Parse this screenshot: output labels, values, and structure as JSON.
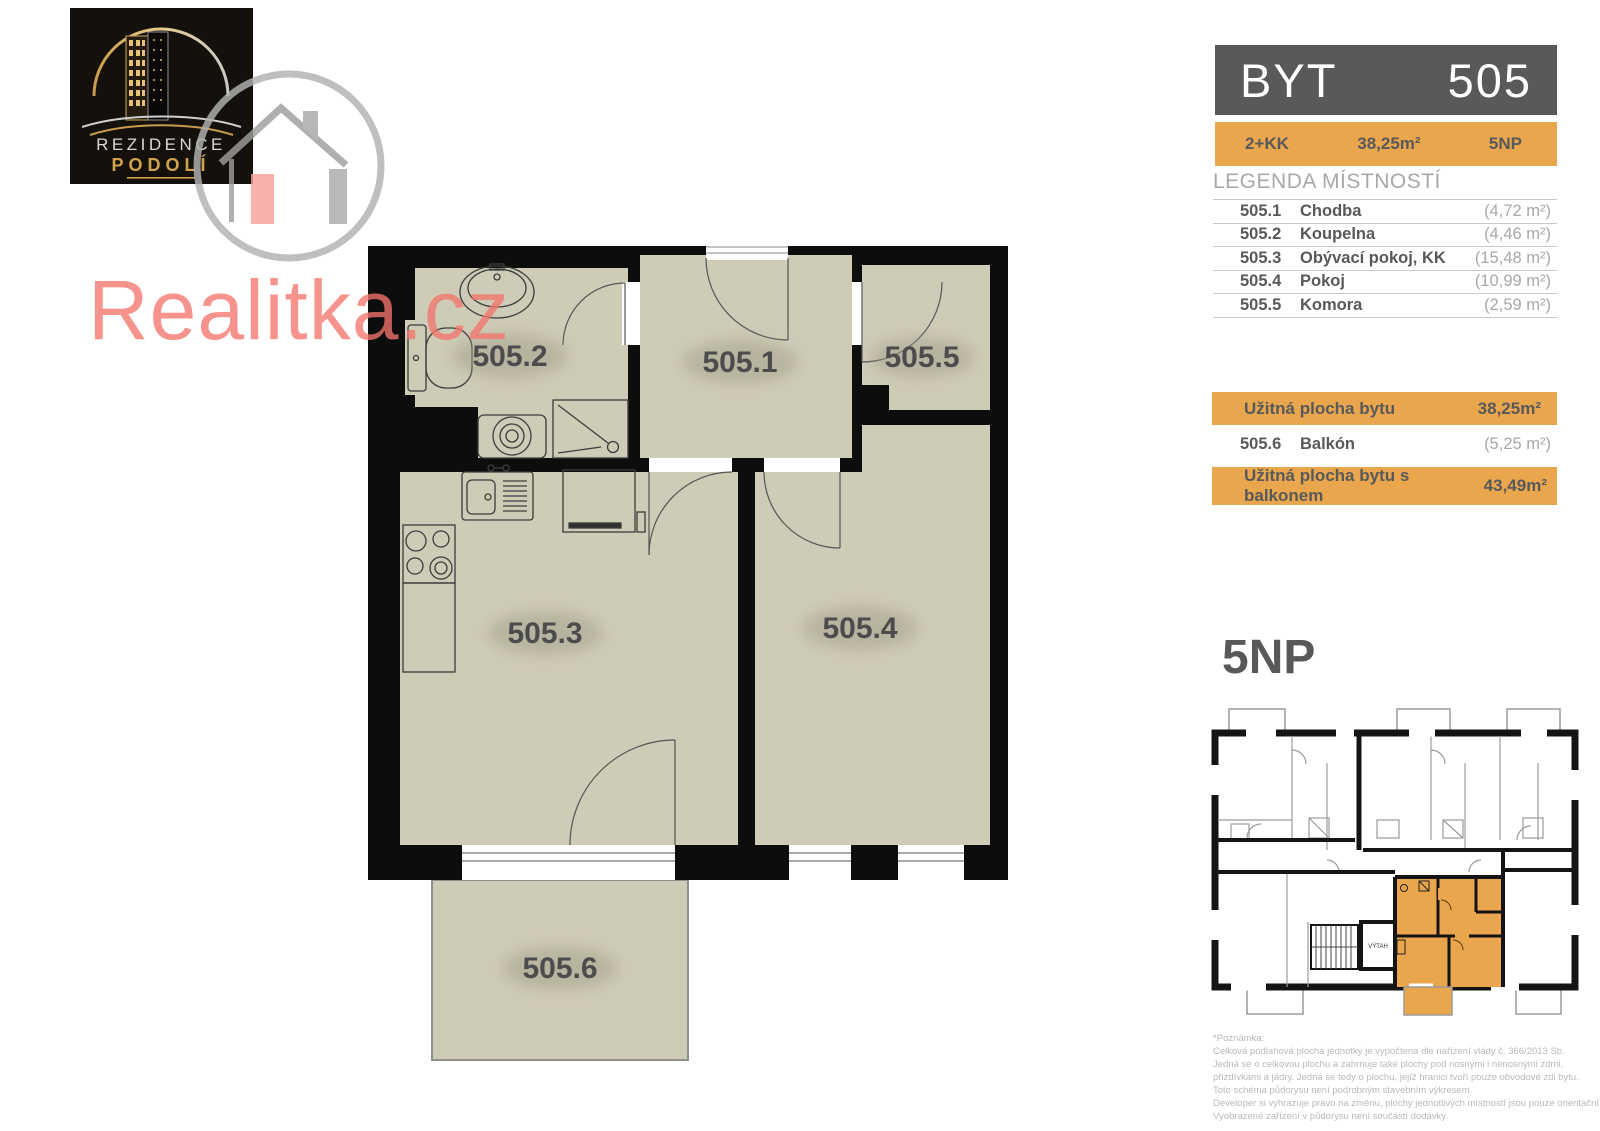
{
  "brand": {
    "logo_line1": "REZIDENCE",
    "logo_line2": "PODOLÍ"
  },
  "watermark": {
    "text": "Realitka.cz"
  },
  "header": {
    "title": "BYT",
    "number": "505"
  },
  "info_bar": {
    "disposition": "2+KK",
    "area": "38,25m²",
    "floor": "5NP"
  },
  "legend": {
    "heading": "LEGENDA MÍSTNOSTÍ",
    "rows": [
      {
        "num": "505.1",
        "name": "Chodba",
        "area": "(4,72 m²)"
      },
      {
        "num": "505.2",
        "name": "Koupelna",
        "area": "(4,46 m²)"
      },
      {
        "num": "505.3",
        "name": "Obývací pokoj, KK",
        "area": "(15,48 m²)"
      },
      {
        "num": "505.4",
        "name": "Pokoj",
        "area": "(10,99 m²)"
      },
      {
        "num": "505.5",
        "name": "Komora",
        "area": "(2,59 m²)"
      }
    ],
    "usable_area": {
      "label": "Užitná plocha bytu",
      "value": "38,25m²"
    },
    "balcony_row": {
      "num": "505.6",
      "name": "Balkón",
      "area": "(5,25 m²)"
    },
    "usable_area_balcony": {
      "label": "Užitná plocha bytu s balkonem",
      "value": "43,49m²"
    }
  },
  "plan": {
    "labels": {
      "r1": "505.1",
      "r2": "505.2",
      "r3": "505.3",
      "r4": "505.4",
      "r5": "505.5",
      "r6": "505.6"
    }
  },
  "floor_plan_overview": {
    "heading": "5NP",
    "elevator_label": "VÝTAH"
  },
  "footnote": {
    "lines": [
      "*Poznámka:",
      "Celková podlahová plocha jednotky je vypočtena dle nařízení vlády č. 366/2013 Sb.",
      "Jedná se o celkovou plochu a zahrnuje také plochy pod nosnými i nenosnými zdmi,",
      "přizdívkami a jádry. Jedná se tedy o plochu, jejíž hranici tvoří pouze obvodové zdi bytu.",
      "Toto schéma půdorysu není podrobným stavebním výkresem.",
      "Developer si vyhrazuje právo na změnu, plochy jednotlivých místností jsou pouze orientační.",
      "Vyobrazené zařízení v půdorysu není součástí dodávky."
    ]
  },
  "colors": {
    "accent_orange": "#EAA64D",
    "header_gray": "#58595B",
    "room_fill": "#CECBB6",
    "wall_black": "#0D0D0D",
    "watermark_red": "#F37066",
    "logo_gold": "#D1A14B"
  }
}
